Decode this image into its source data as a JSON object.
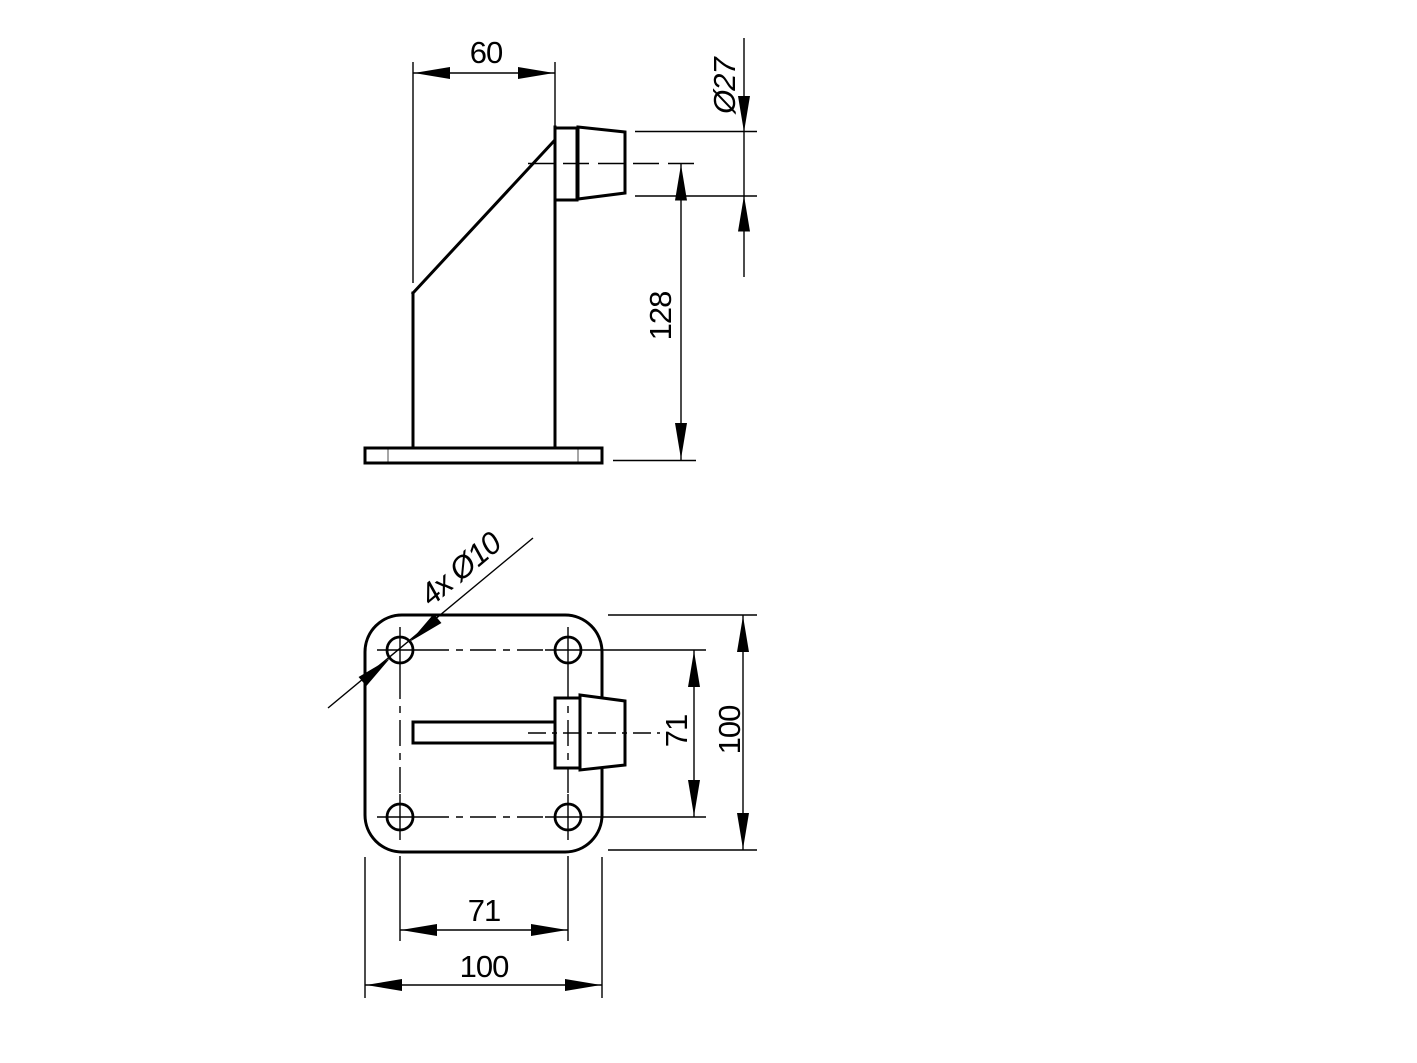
{
  "colors": {
    "background": "#ffffff",
    "line": "#000000",
    "corner_tick": "#8f8f8f"
  },
  "side_view": {
    "dims": {
      "column_width": "60",
      "stop_diameter": "Ø27",
      "stop_center_height": "128"
    }
  },
  "plan_view": {
    "dims": {
      "hole_callout": "4x Ø10",
      "hole_spacing_vertical": "71",
      "plate_height": "100",
      "hole_spacing_horizontal": "71",
      "plate_width": "100"
    }
  }
}
